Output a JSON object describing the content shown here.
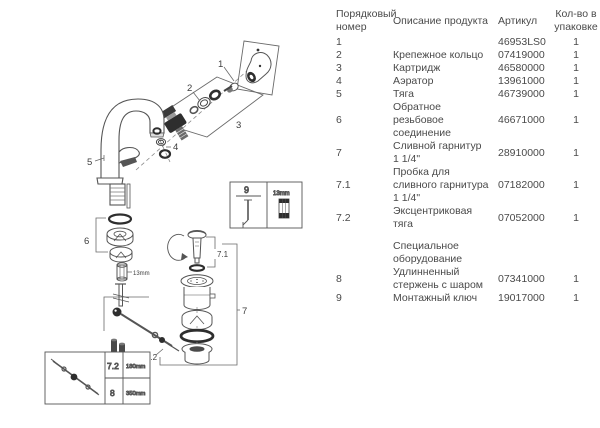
{
  "table": {
    "headers": {
      "num": "Порядковый\nномер",
      "desc": "Описание продукта",
      "article": "Артикул",
      "qty": "Кол-во в\nупаковке"
    },
    "rows": [
      {
        "num": "1",
        "desc": "",
        "article": "46953LS0",
        "qty": "1"
      },
      {
        "num": "2",
        "desc": "Крепежное кольцо",
        "article": "07419000",
        "qty": "1"
      },
      {
        "num": "3",
        "desc": "Картридж",
        "article": "46580000",
        "qty": "1"
      },
      {
        "num": "4",
        "desc": "Аэратор",
        "article": "13961000",
        "qty": "1"
      },
      {
        "num": "5",
        "desc": "Тяга",
        "article": "46739000",
        "qty": "1"
      },
      {
        "num": "6",
        "desc": "Обратное\nрезьбовое\nсоединение",
        "article": "46671000",
        "qty": "1"
      },
      {
        "num": "7",
        "desc": "Сливной гарнитур\n1 1/4\"",
        "article": "28910000",
        "qty": "1"
      },
      {
        "num": "7.1",
        "desc": "Пробка для\nсливного гарнитура\n1 1/4\"",
        "article": "07182000",
        "qty": "1"
      },
      {
        "num": "7.2",
        "desc": "Эксцентриковая\nтяга",
        "article": "07052000",
        "qty": "1"
      }
    ],
    "section_header": "Специальное\nоборудование",
    "special_rows": [
      {
        "num": "8",
        "desc": "Удлинненный\nстержень с шаром",
        "article": "07341000",
        "qty": "1"
      },
      {
        "num": "9",
        "desc": "Монтажный ключ",
        "article": "19017000",
        "qty": "1"
      }
    ]
  },
  "diagram": {
    "callouts": {
      "handle": "1",
      "fastening_ring": "2",
      "cartridge": "3",
      "aerator": "4",
      "rod": "5",
      "connection": "6",
      "drain": "7",
      "plug": "7.1",
      "eccentric_rod": "7.2"
    },
    "annotations": {
      "nut_size": "13mm",
      "key_box_number": "9",
      "key_socket_size": "13mm"
    },
    "size_box": {
      "rows": [
        {
          "id": "7.2",
          "length": "180mm"
        },
        {
          "id": "8",
          "length": "350mm"
        }
      ]
    },
    "colors": {
      "line": "#5a5a5a",
      "dark_part": "#2e2e2e",
      "text": "#3d3d3d"
    }
  }
}
